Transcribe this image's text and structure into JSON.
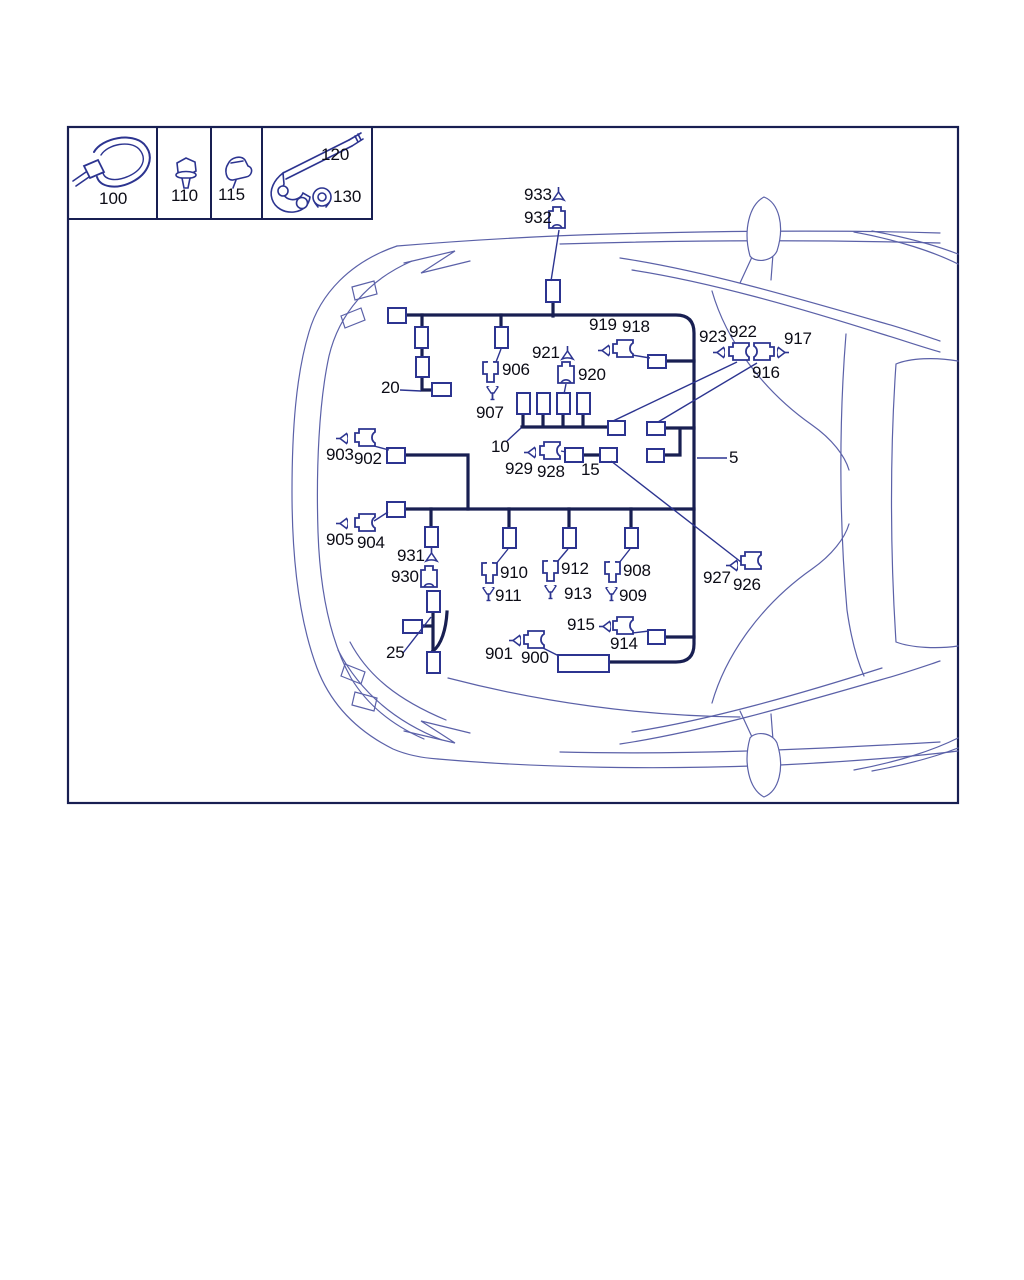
{
  "colors": {
    "ink": "#181f52",
    "rect_stroke": "#2c3490",
    "car_line": "#5b61a8",
    "text": "#0c0c16",
    "background": "#ffffff"
  },
  "legend": {
    "items": [
      {
        "name": "cable-tie",
        "label": "100"
      },
      {
        "name": "screw",
        "label": "110"
      },
      {
        "name": "clip",
        "label": "115"
      },
      {
        "name": "bracket",
        "label": "120"
      },
      {
        "name": "bolt",
        "label": "130"
      }
    ]
  },
  "parts": [
    {
      "label": "933",
      "lx": 524,
      "ly": 186,
      "icon": "cone_up",
      "ix": 551,
      "iy": 187
    },
    {
      "label": "932",
      "lx": 524,
      "ly": 209,
      "icon": "plug_b",
      "ix": 548,
      "iy": 206
    },
    {
      "label": "921",
      "lx": 532,
      "ly": 344,
      "icon": "cone_up",
      "ix": 560,
      "iy": 346
    },
    {
      "label": "920",
      "lx": 578,
      "ly": 366,
      "icon": "plug_b",
      "ix": 557,
      "iy": 361
    },
    {
      "label": "906",
      "lx": 502,
      "ly": 361,
      "icon": "plug_a",
      "ix": 482,
      "iy": 361
    },
    {
      "label": "907",
      "lx": 476,
      "ly": 404,
      "icon": "funnel_down",
      "ix": 486,
      "iy": 386
    },
    {
      "label": "919",
      "lx": 589,
      "ly": 316,
      "icon": "cone_right",
      "ix": 598,
      "iy": 344
    },
    {
      "label": "918",
      "lx": 622,
      "ly": 318,
      "icon": "plug_c",
      "ix": 612,
      "iy": 339
    },
    {
      "label": "923",
      "lx": 699,
      "ly": 328,
      "icon": "cone_right",
      "ix": 713,
      "iy": 346
    },
    {
      "label": "922",
      "lx": 729,
      "ly": 323,
      "icon": "plug_c",
      "ix": 728,
      "iy": 342
    },
    {
      "label": "916",
      "lx": 752,
      "ly": 364,
      "icon": "plug_d",
      "ix": 753,
      "iy": 342
    },
    {
      "label": "917",
      "lx": 784,
      "ly": 330,
      "icon": "cone_left",
      "ix": 777,
      "iy": 346
    },
    {
      "label": "10",
      "lx": 491,
      "ly": 438
    },
    {
      "label": "929",
      "lx": 505,
      "ly": 460,
      "icon": "cone_right",
      "ix": 524,
      "iy": 446
    },
    {
      "label": "928",
      "lx": 537,
      "ly": 463,
      "icon": "plug_c",
      "ix": 539,
      "iy": 441
    },
    {
      "label": "15",
      "lx": 581,
      "ly": 461
    },
    {
      "label": "5",
      "lx": 729,
      "ly": 449
    },
    {
      "label": "20",
      "lx": 381,
      "ly": 379
    },
    {
      "label": "903",
      "lx": 326,
      "ly": 446,
      "icon": "cone_right",
      "ix": 336,
      "iy": 432
    },
    {
      "label": "902",
      "lx": 354,
      "ly": 450,
      "icon": "plug_c",
      "ix": 354,
      "iy": 428
    },
    {
      "label": "905",
      "lx": 326,
      "ly": 531,
      "icon": "cone_right",
      "ix": 336,
      "iy": 517
    },
    {
      "label": "904",
      "lx": 357,
      "ly": 534,
      "icon": "plug_c",
      "ix": 354,
      "iy": 513
    },
    {
      "label": "931",
      "lx": 397,
      "ly": 547,
      "icon": "cone_up",
      "ix": 424,
      "iy": 548
    },
    {
      "label": "930",
      "lx": 391,
      "ly": 568,
      "icon": "plug_b",
      "ix": 420,
      "iy": 565
    },
    {
      "label": "25",
      "lx": 386,
      "ly": 644
    },
    {
      "label": "910",
      "lx": 500,
      "ly": 564,
      "icon": "plug_a",
      "ix": 481,
      "iy": 562
    },
    {
      "label": "911",
      "lx": 495,
      "ly": 587,
      "icon": "funnel_down",
      "ix": 482,
      "iy": 587
    },
    {
      "label": "912",
      "lx": 561,
      "ly": 560,
      "icon": "plug_a",
      "ix": 542,
      "iy": 560
    },
    {
      "label": "913",
      "lx": 564,
      "ly": 585,
      "icon": "funnel_down",
      "ix": 544,
      "iy": 585
    },
    {
      "label": "908",
      "lx": 623,
      "ly": 562,
      "icon": "plug_a",
      "ix": 604,
      "iy": 561
    },
    {
      "label": "909",
      "lx": 619,
      "ly": 587,
      "icon": "funnel_down",
      "ix": 605,
      "iy": 587
    },
    {
      "label": "927",
      "lx": 703,
      "ly": 569,
      "icon": "cone_right",
      "ix": 726,
      "iy": 559
    },
    {
      "label": "926",
      "lx": 733,
      "ly": 576,
      "icon": "plug_c",
      "ix": 740,
      "iy": 551
    },
    {
      "label": "915",
      "lx": 567,
      "ly": 616,
      "icon": "cone_right",
      "ix": 599,
      "iy": 620
    },
    {
      "label": "914",
      "lx": 610,
      "ly": 635,
      "icon": "plug_c",
      "ix": 612,
      "iy": 616
    },
    {
      "label": "901",
      "lx": 485,
      "ly": 645,
      "icon": "cone_right",
      "ix": 509,
      "iy": 634
    },
    {
      "label": "900",
      "lx": 521,
      "ly": 649,
      "icon": "plug_c",
      "ix": 523,
      "iy": 630
    }
  ],
  "rects": [
    [
      388,
      308,
      18,
      15
    ],
    [
      415,
      327,
      13,
      21
    ],
    [
      416,
      357,
      13,
      20
    ],
    [
      432,
      383,
      19,
      13
    ],
    [
      495,
      327,
      13,
      21
    ],
    [
      546,
      280,
      14,
      22
    ],
    [
      517,
      393,
      13,
      21
    ],
    [
      537,
      393,
      13,
      21
    ],
    [
      557,
      393,
      13,
      21
    ],
    [
      577,
      393,
      13,
      21
    ],
    [
      648,
      355,
      18,
      13
    ],
    [
      608,
      421,
      17,
      14
    ],
    [
      647,
      422,
      18,
      13
    ],
    [
      647,
      449,
      17,
      13
    ],
    [
      387,
      448,
      18,
      15
    ],
    [
      387,
      502,
      18,
      15
    ],
    [
      425,
      527,
      13,
      20
    ],
    [
      503,
      528,
      13,
      20
    ],
    [
      563,
      528,
      13,
      20
    ],
    [
      625,
      528,
      13,
      20
    ],
    [
      565,
      448,
      18,
      14
    ],
    [
      600,
      448,
      17,
      14
    ],
    [
      427,
      591,
      13,
      21
    ],
    [
      403,
      620,
      19,
      13
    ],
    [
      427,
      652,
      13,
      21
    ],
    [
      648,
      630,
      17,
      14
    ],
    [
      558,
      655,
      51,
      17
    ]
  ],
  "leaders": [
    [
      559,
      230,
      551,
      281
    ],
    [
      496,
      362,
      501,
      349
    ],
    [
      566,
      384,
      564,
      394
    ],
    [
      632,
      355,
      650,
      358
    ],
    [
      613,
      421,
      737,
      362
    ],
    [
      658,
      422,
      757,
      363
    ],
    [
      507,
      441,
      521,
      428
    ],
    [
      400,
      390,
      421,
      391
    ],
    [
      697,
      458,
      727,
      458
    ],
    [
      561,
      451,
      566,
      452
    ],
    [
      611,
      461,
      741,
      562
    ],
    [
      374,
      446,
      389,
      450
    ],
    [
      374,
      521,
      388,
      512
    ],
    [
      496,
      564,
      508,
      549
    ],
    [
      557,
      562,
      568,
      549
    ],
    [
      619,
      563,
      630,
      549
    ],
    [
      632,
      633,
      649,
      631
    ],
    [
      543,
      648,
      559,
      656
    ],
    [
      403,
      653,
      431,
      617
    ]
  ]
}
